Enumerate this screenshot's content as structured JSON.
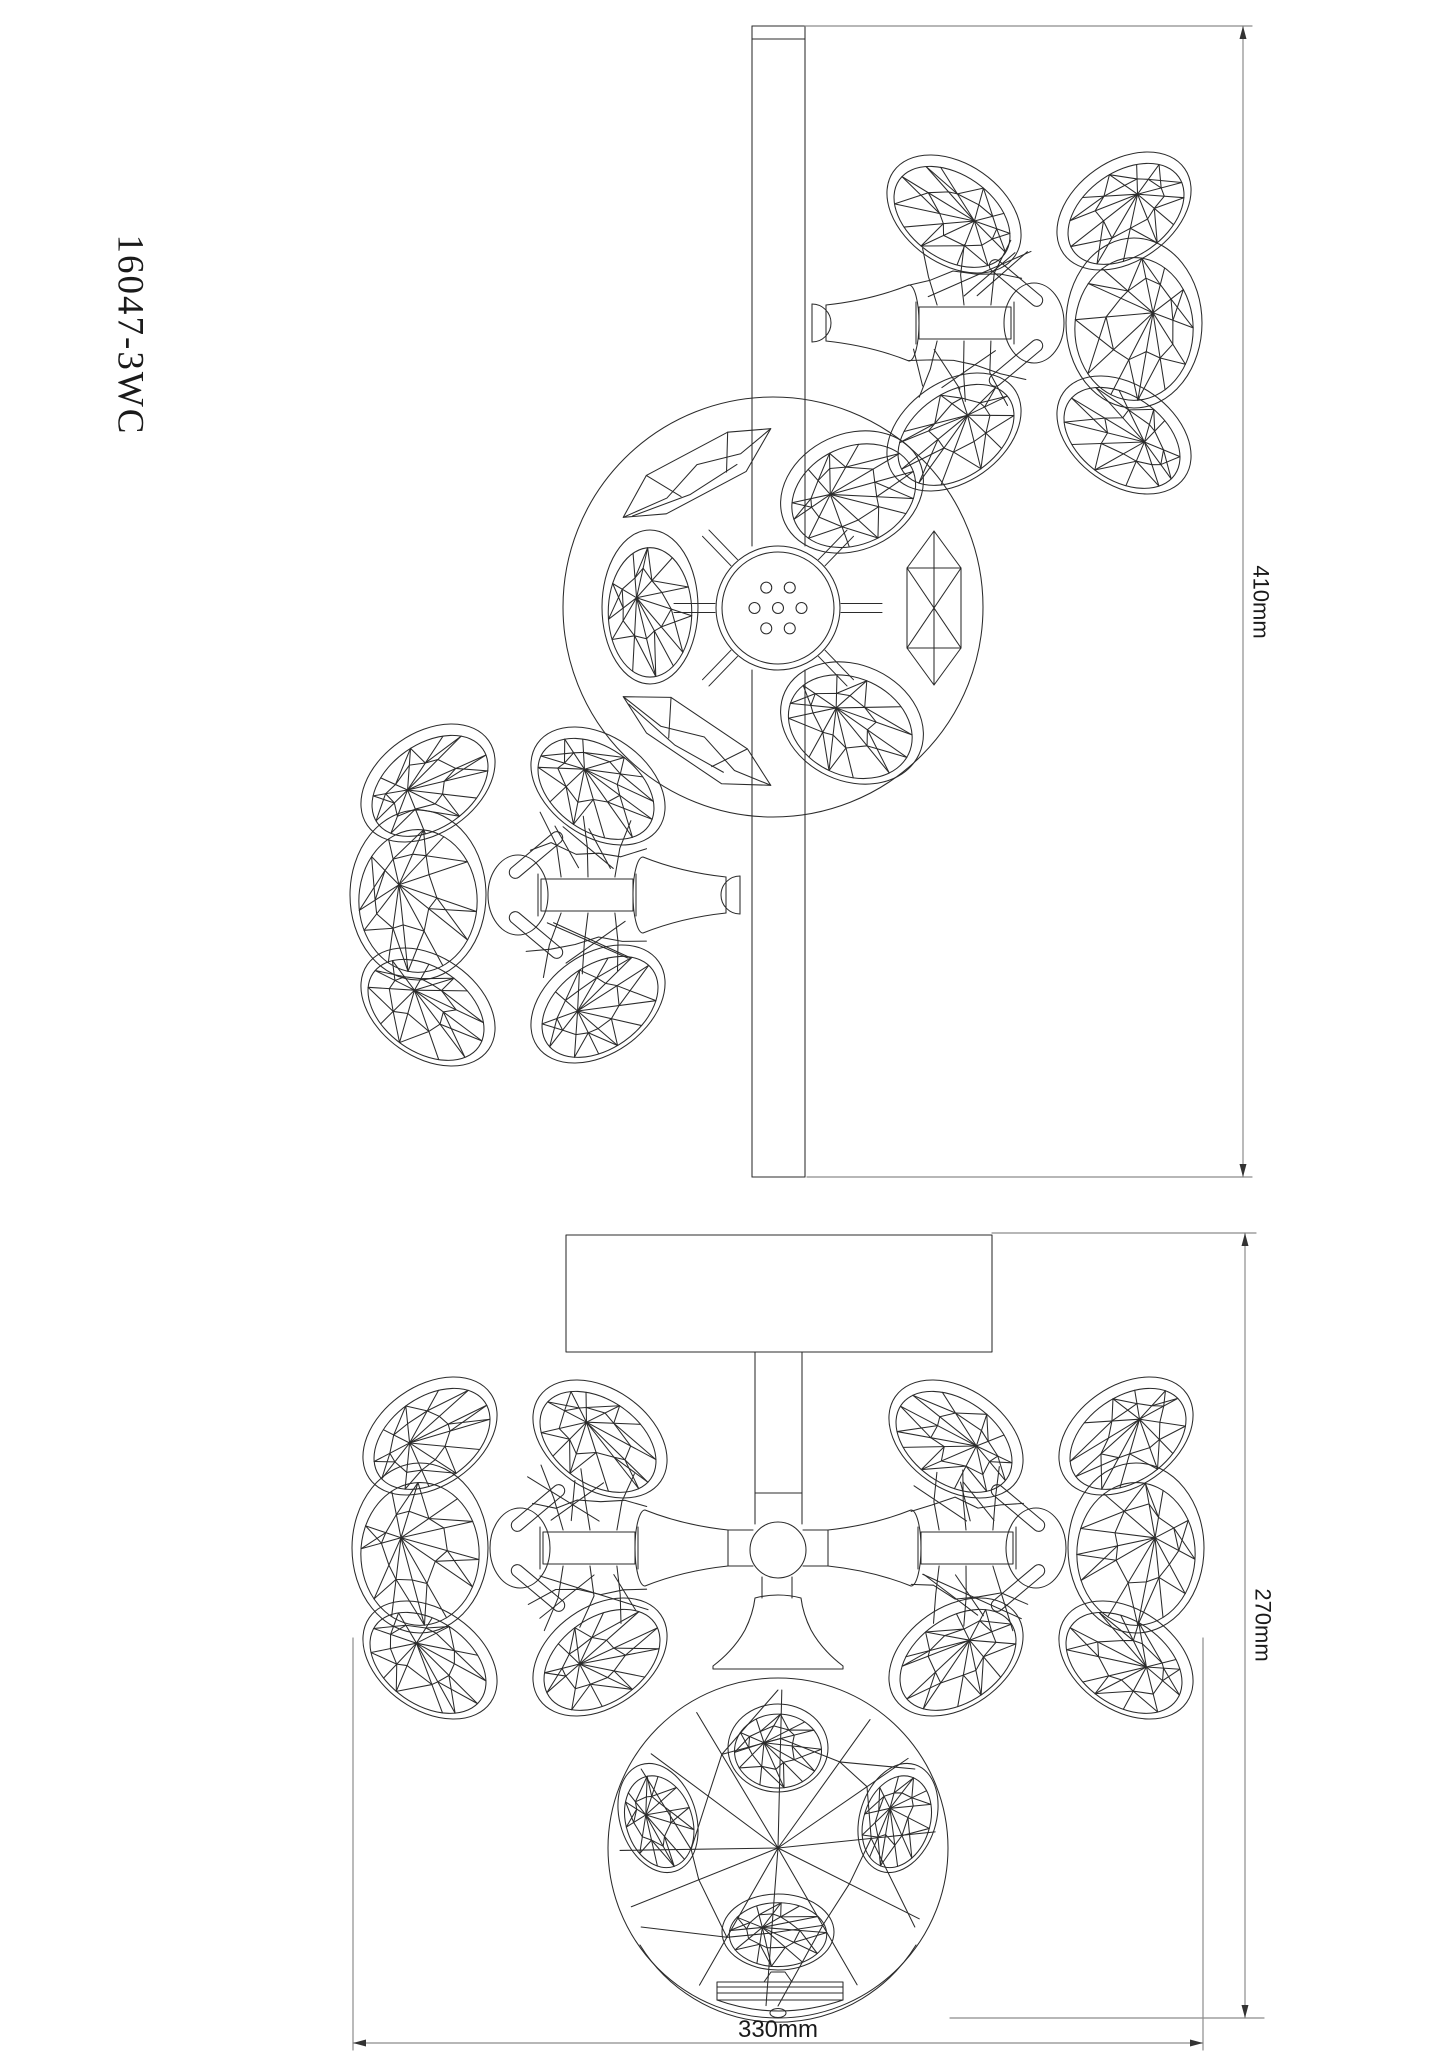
{
  "labels": {
    "model_number": "16047-3WC",
    "top_view_height": "410mm",
    "front_view_height": "270mm",
    "front_view_width": "330mm"
  },
  "colors": {
    "line": "#2b2b2b",
    "dimension_line": "#8c8c8c",
    "text": "#1a1a1a",
    "background": "#ffffff"
  }
}
